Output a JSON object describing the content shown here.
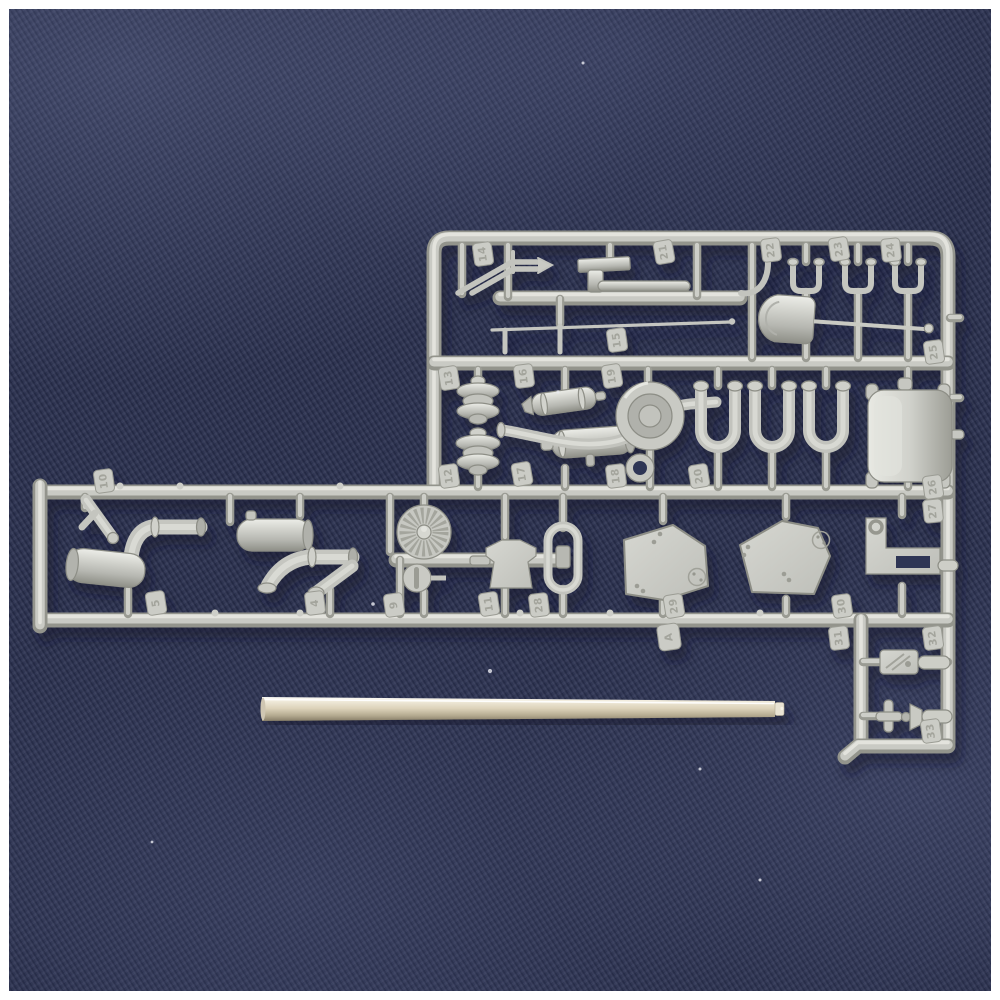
{
  "colors": {
    "photo_frame": "#ffffff",
    "fabric_navy": "#2b3150",
    "fabric_sheen": "#6e7aa8",
    "sprue_plastic": "#c9cac4",
    "sprue_shadow_edge": "#8d8e86",
    "metal_rod_tan": "#dcd2b9",
    "metal_rod_highlight": "#ffffff",
    "cast_shadow": "#0c102a"
  },
  "tags": [
    "14",
    "21",
    "22",
    "23",
    "24",
    "15",
    "25",
    "13",
    "16",
    "19",
    "12",
    "17",
    "18",
    "20",
    "26",
    "27",
    "9",
    "11",
    "28",
    "29",
    "A",
    "30",
    "31",
    "32",
    "33",
    "10",
    "5",
    "4"
  ]
}
